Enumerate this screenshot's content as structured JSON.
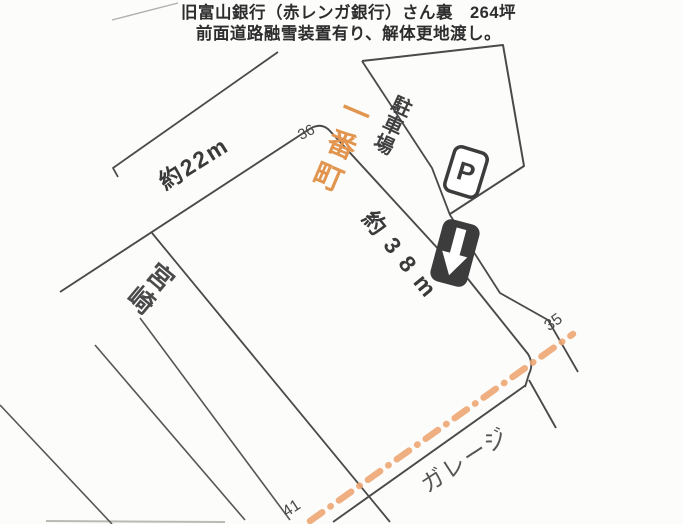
{
  "header": {
    "line1": "旧富山銀行（赤レンガ銀行）さん裏　264坪",
    "line2": "前面道路融雪装置有り、解体更地渡し。"
  },
  "map": {
    "street_name": "一番町",
    "frontage_top": "約22m",
    "frontage_side": "約38m",
    "parking_lot_label": "駐車場",
    "parking_sign_letter": "P",
    "neighbor_west": "宮崎",
    "neighbor_south": "ガレージ",
    "lot_number_top": "36",
    "lot_number_east": "35",
    "lot_number_south": "41",
    "icons": [
      "parking-sign-icon",
      "one-way-arrow-icon"
    ],
    "colors": {
      "street_name_text": "#e2954f",
      "road_dash_marking": "#eda672",
      "boundary_line": "#4a4a4a",
      "sign_dark": "#3c3c3c",
      "paper": "#fcfcfb"
    }
  }
}
